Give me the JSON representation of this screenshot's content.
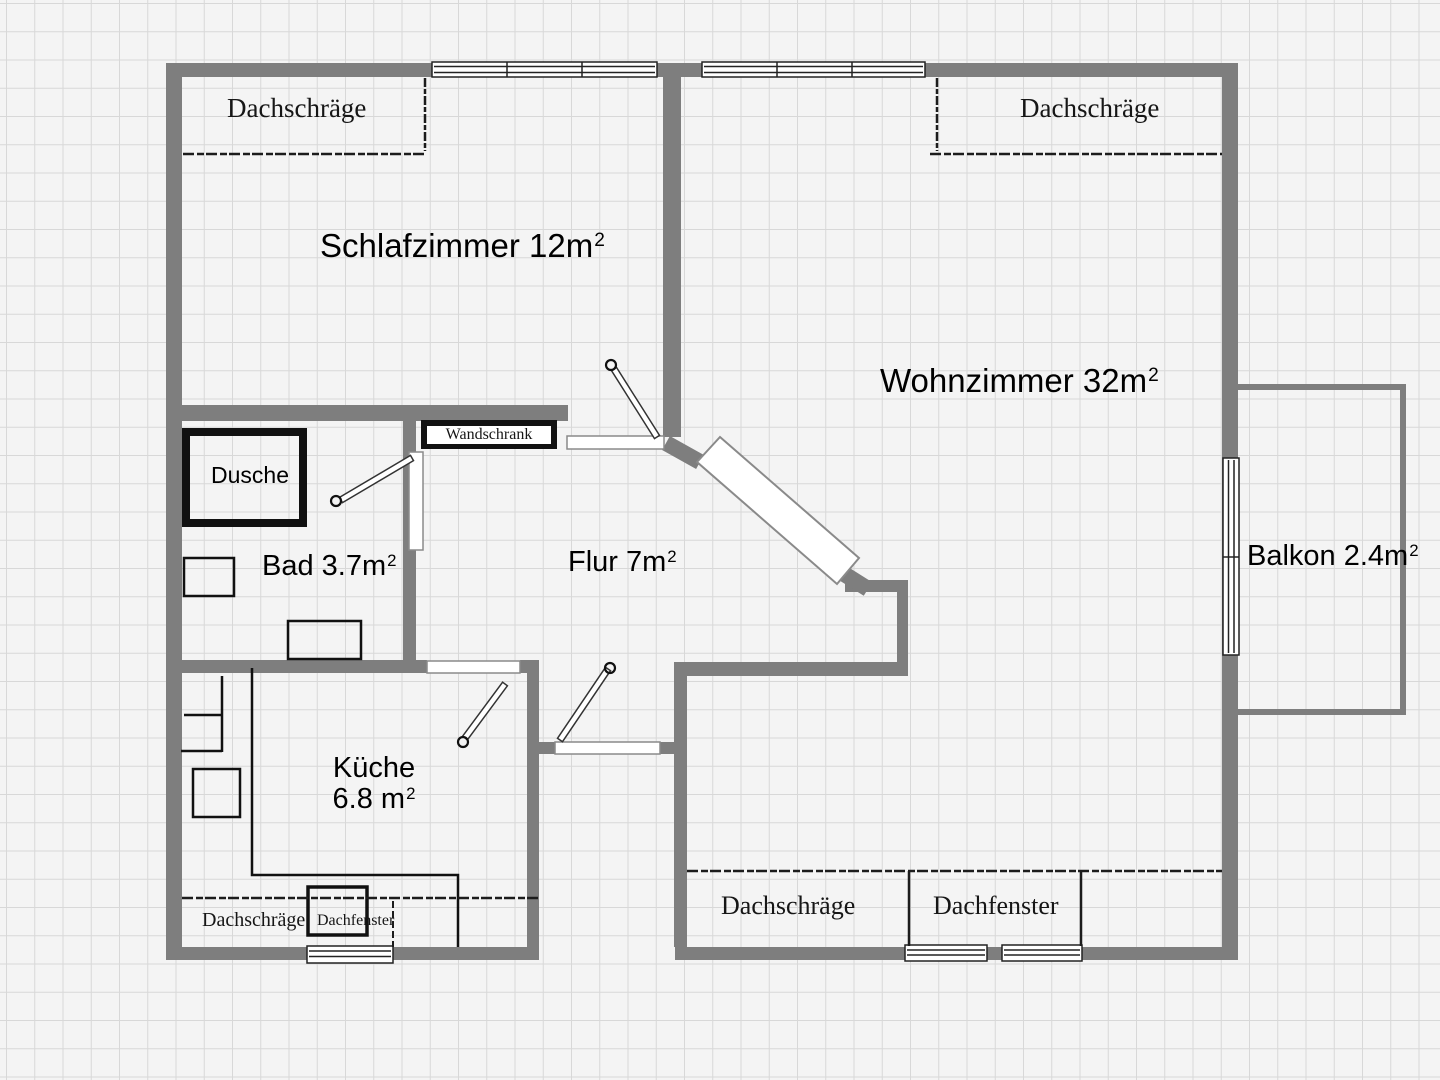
{
  "colors": {
    "wall": "#7e7e7e",
    "background": "#f4f4f4",
    "grid_line": "#d8d8d8",
    "ink": "#161616"
  },
  "rooms": {
    "schlafzimmer": {
      "label": "Schlafzimmer 12m",
      "sup": "2"
    },
    "wohnzimmer": {
      "label": "Wohnzimmer 32m",
      "sup": "2"
    },
    "bad": {
      "label": "Bad 3.7m",
      "sup": "2"
    },
    "flur": {
      "label": "Flur 7m",
      "sup": "2"
    },
    "kueche": {
      "line1": "Küche",
      "line2": "6.8 m",
      "sup": "2"
    },
    "balkon": {
      "label": "Balkon 2.4m",
      "sup": "2"
    },
    "dusche": {
      "label": "Dusche"
    },
    "wandschrank": {
      "label": "Wandschrank"
    }
  },
  "annotations": {
    "dachschraege_top_left": "Dachschräge",
    "dachschraege_top_right": "Dachschräge",
    "dachschraege_bottom_left": "Dachschräge",
    "dachfenster_bottom_left": "Dachfenster",
    "dachschraege_bottom_mid": "Dachschräge",
    "dachfenster_bottom_mid": "Dachfenster"
  }
}
